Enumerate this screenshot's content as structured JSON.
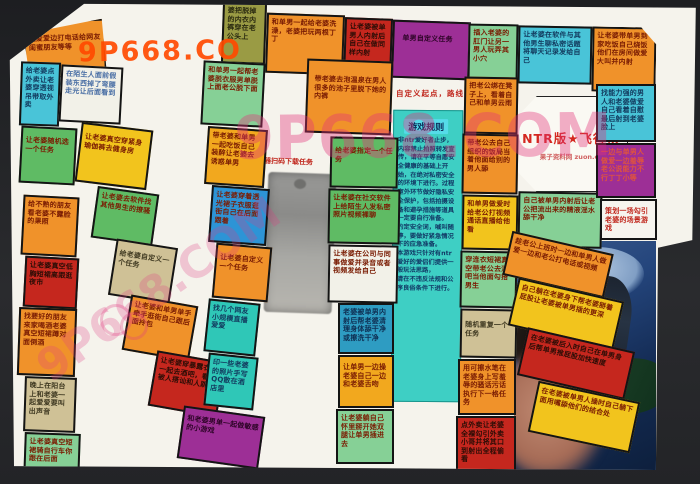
{
  "title": {
    "main": "NTR版★飞行棋",
    "sub": "果子资料网 zuon.cc"
  },
  "start_note": "自定义起点，路线",
  "qr_caption": "浏览器扫码下载任务",
  "rules": {
    "title": "游戏规则",
    "body": "非ntr爱好者止步，内容禁止拍照转发宣传，请在平等自愿安全健康的基础上开始，在绝对私密安全的环境下进行。过程室外环节做好隐私安全保护，包括拍摄设备和避孕措施等道具一定要自行准备。\n约定安全词，喊叫随停，要做好紧急情况下的应急准备。\n本游戏只针对有ntr爱好的爱侣们提供一般玩法思路，\n请在不违反法规和公序良俗条件下进行。"
  },
  "watermarks": {
    "top": "9P668.CO",
    "big": "9P668.COM",
    "diagonal": "9P668.COM"
  },
  "colors": {
    "orange": "#f0922a",
    "gold": "#f2a81e",
    "yellow": "#f2c41d",
    "red": "#c5271e",
    "green": "#5fbb64",
    "mint": "#86d096",
    "cyan": "#49c4d8",
    "teal": "#2fc7b7",
    "blue": "#2d94d6",
    "tan": "#cfc196",
    "olive": "#9a9b44",
    "purple": "#9d2f96",
    "title_red": "#d42820",
    "watermark_orange": "#ff4a00",
    "watermark_pink": "#e13278"
  },
  "cells": [
    {
      "id": "t1",
      "color": "orange",
      "text": "边爱爱边打电话给网友闺蜜朋友等等"
    },
    {
      "id": "t2",
      "color": "olive",
      "text": "婆把脱掉的内衣内裤穿在老公头上"
    },
    {
      "id": "t3",
      "color": "orange",
      "text": "和单男一起给老婆洗澡，老婆把玩两根丁丁"
    },
    {
      "id": "t4",
      "color": "red",
      "text": "让老婆被单男人内射后自己在做同样内射"
    },
    {
      "id": "t5",
      "color": "purple",
      "text": "单男自定义任务"
    },
    {
      "id": "t6",
      "color": "mint",
      "text": "插入老婆的肛门让另一男人玩弄其小穴"
    },
    {
      "id": "t7",
      "color": "cyan",
      "text": "让老婆在软件与其他男生聊私密话题将聊天记录发给自己"
    },
    {
      "id": "t8",
      "color": "orange",
      "text": "让老婆带单男到家吃饭自己烧饭他们在房间做爱大叫并内射"
    },
    {
      "id": "a1",
      "color": "cyan",
      "text": "给老婆点外卖让老婆穿透视吊带取外卖"
    },
    {
      "id": "b1",
      "color": "white",
      "text": "在陌生人面前假装东西掉了弯腰走光让后面看到"
    },
    {
      "id": "a2",
      "color": "green",
      "text": "让老婆随机选一个任务"
    },
    {
      "id": "a3",
      "color": "orange",
      "text": "给不熟的朋友看老婆不露脸的果照"
    },
    {
      "id": "a4",
      "color": "red",
      "text": "让老婆真空低胸短裙高跟逛夜市"
    },
    {
      "id": "a5",
      "color": "orange",
      "text": "找要好的朋友来家喝酒老婆真空短裙蹲对面倒酒"
    },
    {
      "id": "a6",
      "color": "tan",
      "text": "晚上在阳台上和老婆一起爱爱要叫出声音"
    },
    {
      "id": "a7",
      "color": "mint",
      "text": "让老婆真空短裙骑自行车你跟在后面"
    },
    {
      "id": "b2",
      "color": "yellow",
      "text": "让老婆真空穿紧身瑜伽裤去健身房"
    },
    {
      "id": "b3",
      "color": "green",
      "text": "让老婆去软件找其他男生的撩骚"
    },
    {
      "id": "b4",
      "color": "tan",
      "text": "给老婆自定义一个任务"
    },
    {
      "id": "b5",
      "color": "orange",
      "text": "让老婆和单男单手牵手逛街自己跟后面拎包"
    },
    {
      "id": "b6",
      "color": "red",
      "text": "让老婆穿暴露衣服一起去酒吧，看她被人搭讪和人跳舞"
    },
    {
      "id": "b7",
      "color": "purple",
      "text": "和老婆男单一起做敏感的小游戏"
    },
    {
      "id": "c1",
      "color": "mint",
      "text": "和单男一起帮老婆脱衣服男单脱上面老公脱下面"
    },
    {
      "id": "c2",
      "color": "gold",
      "text": "带老婆和单男一起吃饭自己装醉让老婆去诱惑单男"
    },
    {
      "id": "c3",
      "color": "blue",
      "text": "让老婆穿着透光裙子衣服逛街自己在后面跟着"
    },
    {
      "id": "c4",
      "color": "orange",
      "text": "让老婆自定义一个任务"
    },
    {
      "id": "c5",
      "color": "teal",
      "text": "找几个网友小规模直播爱爱"
    },
    {
      "id": "c6",
      "color": "teal",
      "text": "印一些老婆的照片手写QQ散在酒店里"
    },
    {
      "id": "d0",
      "color": "orange",
      "text": "带老婆去泡温泉在男人很多的池子里脱下她的内裤"
    },
    {
      "id": "d1",
      "color": "green",
      "text": "给老婆指定一个任务"
    },
    {
      "id": "d2",
      "color": "green",
      "text": "让老婆在社交软件上给陌生人发私密照片视频裸聊"
    },
    {
      "id": "d3",
      "color": "white-warm",
      "text": "让老婆在公司与同事做爱并录音或者视频发给自己"
    },
    {
      "id": "d4",
      "color": "blue2",
      "text": "老婆被单男内射后帮老婆清理身体舔干净或擦洗干净"
    },
    {
      "id": "d5",
      "color": "gold",
      "text": "让单男一边操老婆自己一边和老婆舌吻"
    },
    {
      "id": "d6",
      "color": "mint",
      "text": "让老婆躺自己怀里掰开她双腿让单男插进去"
    },
    {
      "id": "e0",
      "color": "orange",
      "text": "把老公绑在凳子上，看着自己和单男云雨"
    },
    {
      "id": "e1",
      "color": "orange",
      "text": "带老公去自己组织的饭局当着他面给别的男人舔"
    },
    {
      "id": "e2",
      "color": "yellow",
      "text": "和单男做爱时给老公打视频通话直播给他看"
    },
    {
      "id": "e3",
      "color": "mint",
      "text": "穿连衣短裙真空带老公去酒吧当他面勾搭男生"
    },
    {
      "id": "e4",
      "color": "tan",
      "text": "随机重复一个任务"
    },
    {
      "id": "e5",
      "color": "orange",
      "text": "用可擦水笔在老婆身上写羞辱的骚话污话执行下一格任务"
    },
    {
      "id": "e6",
      "color": "red",
      "text": "点外卖让老婆全裸勾引外卖小哥并将其口到射出全程偷看"
    },
    {
      "id": "f1",
      "color": "mint",
      "text": "自己被单男内射后让老公把流出来的精液淫水舔干净"
    },
    {
      "id": "g1",
      "color": "cyan",
      "text": "找能力强的男人和老婆做爱自己看着自慰最后射到老婆脸上"
    },
    {
      "id": "g2",
      "color": "purple2",
      "text": "一边与单男人做爱一边羞辱老公说能力不行丁丁小等"
    },
    {
      "id": "g3",
      "color": "white-red",
      "text": "策划一场勾引老婆的场景游戏"
    },
    {
      "id": "p1",
      "color": "orange",
      "text": "趁老公上班时一边和单男人做爱一边和老公打电话或视频"
    },
    {
      "id": "p2",
      "color": "yellow",
      "text": "自己躺在老婆身下帮老婆掰着屁股让老婆被单男插的更深"
    },
    {
      "id": "p3",
      "color": "red",
      "text": "在老婆被后入时自己在单男身后帮单男推屁股加快速度"
    },
    {
      "id": "p4",
      "color": "yellow",
      "text": "在老婆被单男人操时自己躺下面用嘴舔他们的结合处"
    }
  ]
}
